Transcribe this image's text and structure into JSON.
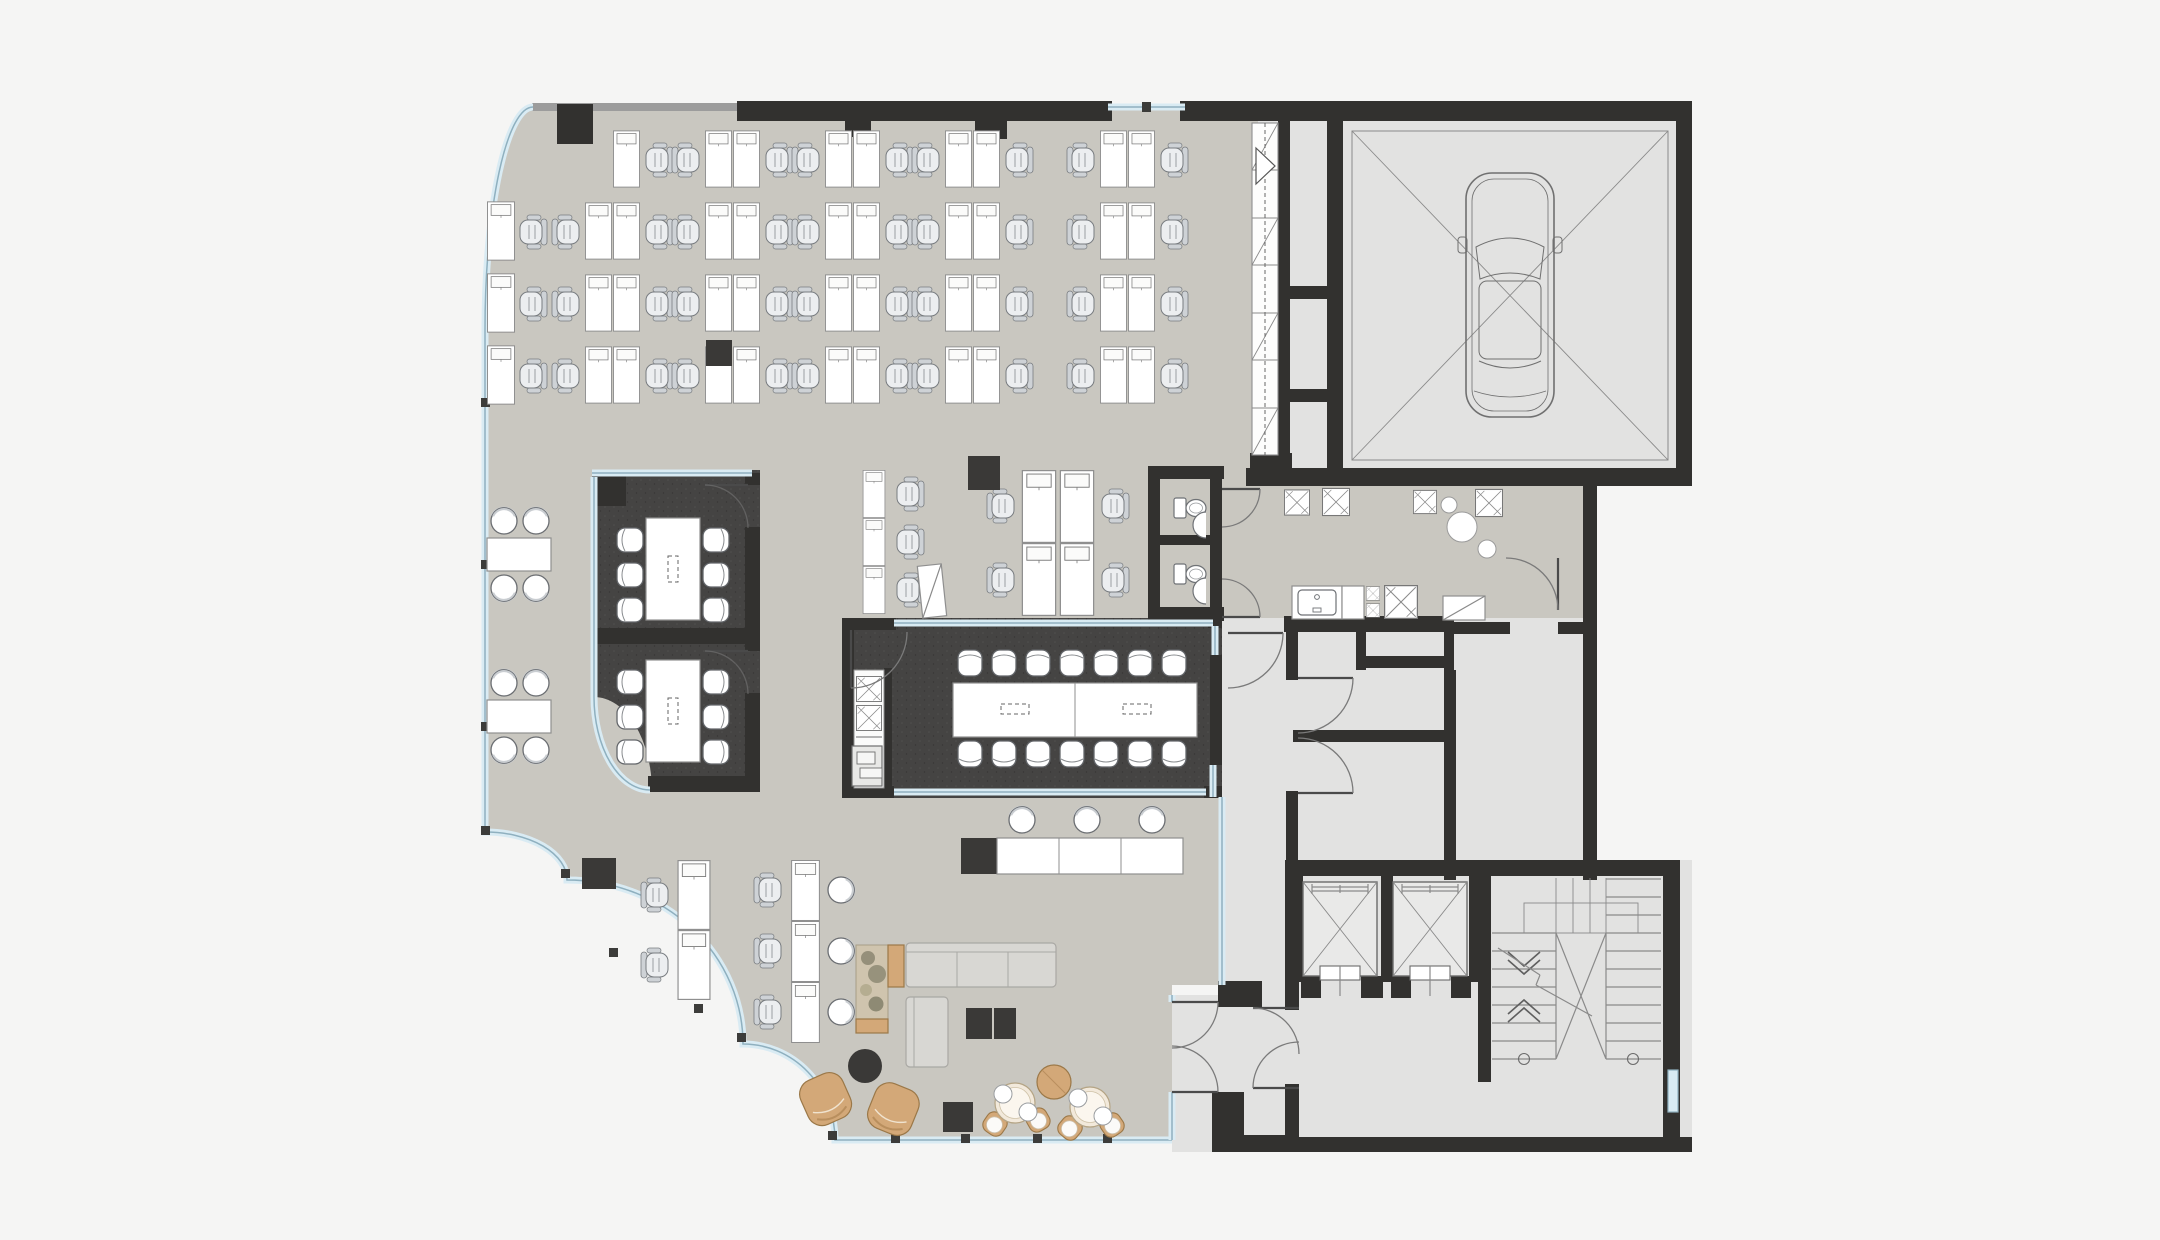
{
  "meta": {
    "kind": "architectural floor plan",
    "view": "top-down furnished office level",
    "visible_text": "none"
  },
  "colors": {
    "page_bg": "#f5f5f4",
    "floor_office": "#c9c7c0",
    "floor_service": "#e2e2e1",
    "floor_dark": "#454443",
    "wall": "#32312f",
    "wall_thin": "#9c9c9c",
    "glass_band": "#d9ebf3",
    "glass_line": "#8fb0bf",
    "line_thin": "#8a8a8a",
    "desk_stroke": "#8f8f8f",
    "chair_fill": "#eceef0",
    "chair_back": "#ced2d6",
    "chair_stroke": "#787c80",
    "wood": "#d3a878",
    "wood_dark": "#9b7848",
    "sofa": "#d8d7d3",
    "sofa_stroke": "#a9a8a4",
    "black_item": "#3a3937",
    "stone_stroke": "#9a9a9a",
    "car_line": "#707070",
    "planter": "#cfc4ae",
    "plant": "#8e8a74"
  },
  "inventory": {
    "open_office": {
      "workstations": 54,
      "task_chairs": 47,
      "side_chairs": 7,
      "round_table_groups": 2,
      "flipchart": 1,
      "structural_columns": 7
    },
    "meeting_room_1": {
      "seats": 6,
      "tables": 1
    },
    "meeting_room_2": {
      "seats": 6,
      "tables": 1
    },
    "conference_room": {
      "seats": 14,
      "table_sections": 2,
      "appliance_niche": 1,
      "printer": 1
    },
    "lounge": {
      "l_shaped_sofa": 1,
      "planter_column": 1,
      "coffee_tables": 2,
      "ottoman": 1,
      "wood_armchairs": 2,
      "cafe_tables": 2,
      "cafe_chairs": 4,
      "bar_table": 1,
      "bar_stools": 3,
      "round_side_table": 1
    },
    "sanitary": {
      "wc_stalls": 2,
      "wash_basins": 2
    },
    "kitchenette": {
      "sink_unit": 1,
      "appliance_shafts": 2
    },
    "core": {
      "passenger_elevators": 2,
      "car_elevator": 1,
      "stairwell": 1,
      "service_shafts": 6,
      "glazed_louvre_strip": 1
    },
    "doors": {
      "single_swing": 8,
      "double_swing_pairs": 3,
      "curved_glass_facade_arcs": 4
    }
  }
}
